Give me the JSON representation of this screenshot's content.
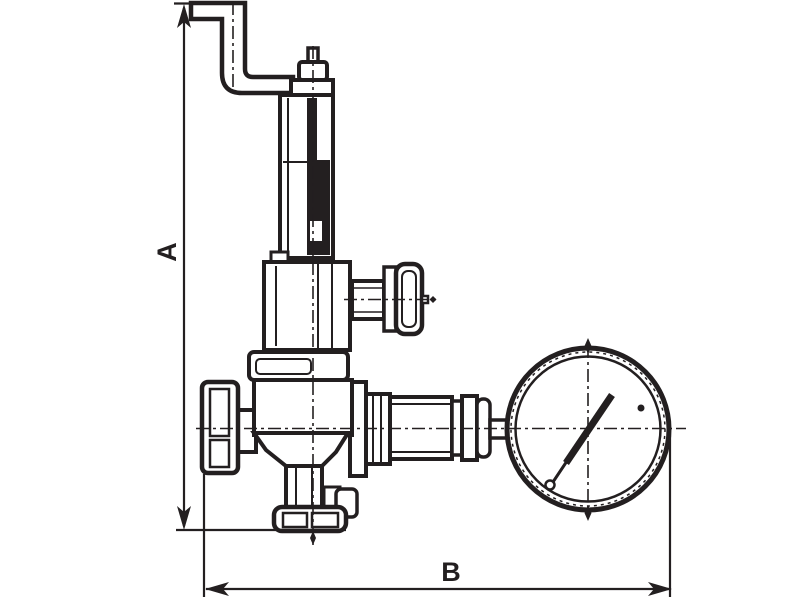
{
  "canvas": {
    "width": 800,
    "height": 598,
    "background": "#ffffff"
  },
  "drawing": {
    "kind": "technical line drawing of a spring safety relief valve with pressure gauge",
    "ink_color": "#231f20",
    "dim_a": {
      "label": "A",
      "orientation": "vertical"
    },
    "dim_b": {
      "label": "B",
      "orientation": "horizontal"
    }
  }
}
